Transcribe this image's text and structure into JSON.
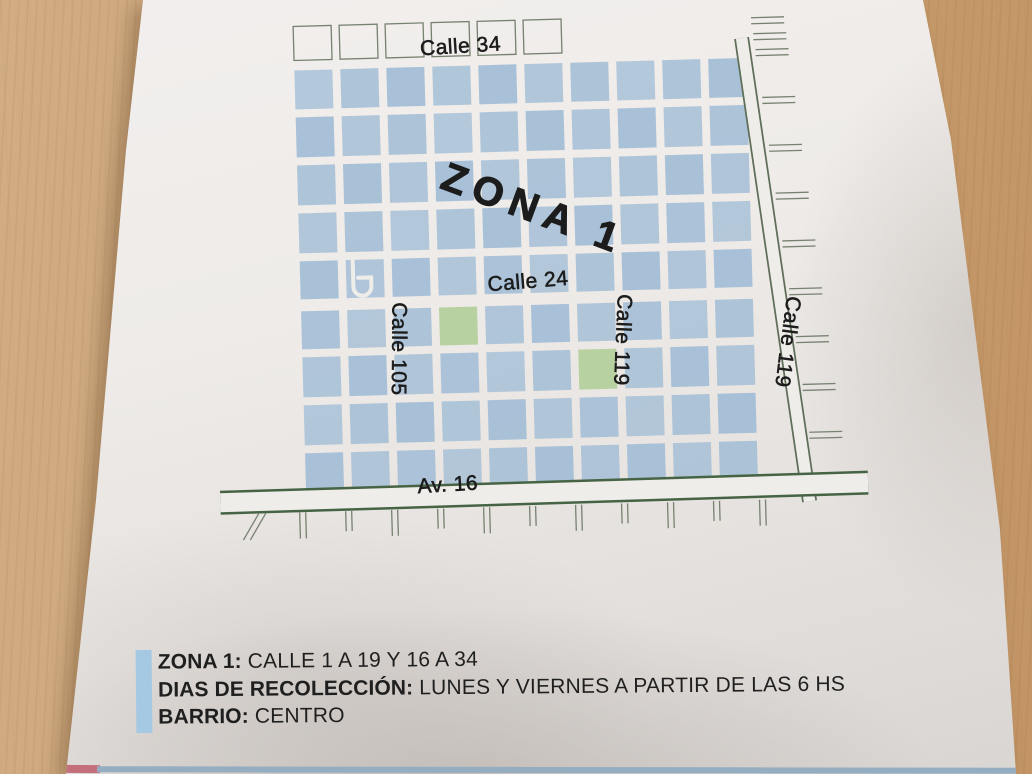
{
  "flyer": {
    "map": {
      "zone_label": "ZONA 1",
      "streets": {
        "top": "Calle 34",
        "middle": "Calle 24",
        "bottom": "Av. 16",
        "vertical_left": "Calle 105",
        "vertical_middle": "Calle 119",
        "vertical_right": "Calle 119"
      }
    },
    "info": {
      "zone_label": "ZONA 1:",
      "zone_value": "CALLE 1 A 19 Y 16 A 34",
      "days_label": "DIAS DE RECOLECCIÓN:",
      "days_value": "LUNES Y VIERNES A PARTIR DE LAS 6 HS",
      "barrio_label": "BARRIO:",
      "barrio_value": "CENTRO"
    }
  },
  "colors": {
    "block_blue": "#a4bed6",
    "park_green": "#b7d1a0",
    "avenue_edge_green": "#466344",
    "diagonal_edge_green": "#5e6e58",
    "outline_gray": "#76816f",
    "street_white": "#efedea",
    "label_dark": "#1c1c1c",
    "info_bar_blue": "#a5c9e3",
    "under_strip_pink": "#c4707c",
    "under_strip_blue": "#94adc0"
  }
}
